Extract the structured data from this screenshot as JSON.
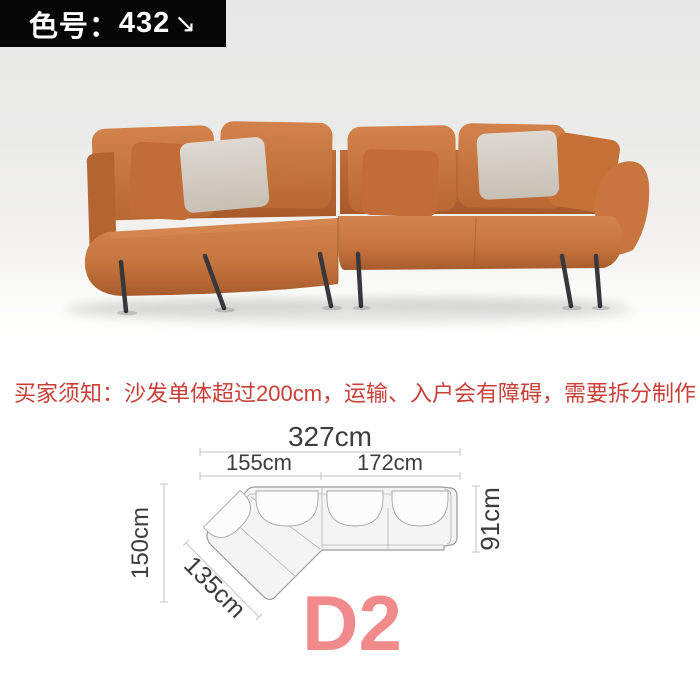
{
  "badge": {
    "label": "色号：",
    "value": "432",
    "arrow": "↘"
  },
  "notice": {
    "text": "买家须知：沙发单体超过200cm，运输、入户会有障碍，需要拆分制作"
  },
  "diagram": {
    "dims": {
      "total_width": "327cm",
      "left_section": "155cm",
      "right_section": "172cm",
      "left_depth": "150cm",
      "chaise_length": "135cm",
      "right_depth": "91cm"
    },
    "model": "D2"
  },
  "colors": {
    "badge_bg": "#060606",
    "notice_red": "#c84038",
    "model_pink": "#f18a8a",
    "leather_orange": "#c9763f",
    "pillow_gray": "#d9d3ca",
    "leg_dark": "#38383c",
    "diagram_line": "#c3c3c3",
    "diagram_text": "#3d3d3d"
  }
}
